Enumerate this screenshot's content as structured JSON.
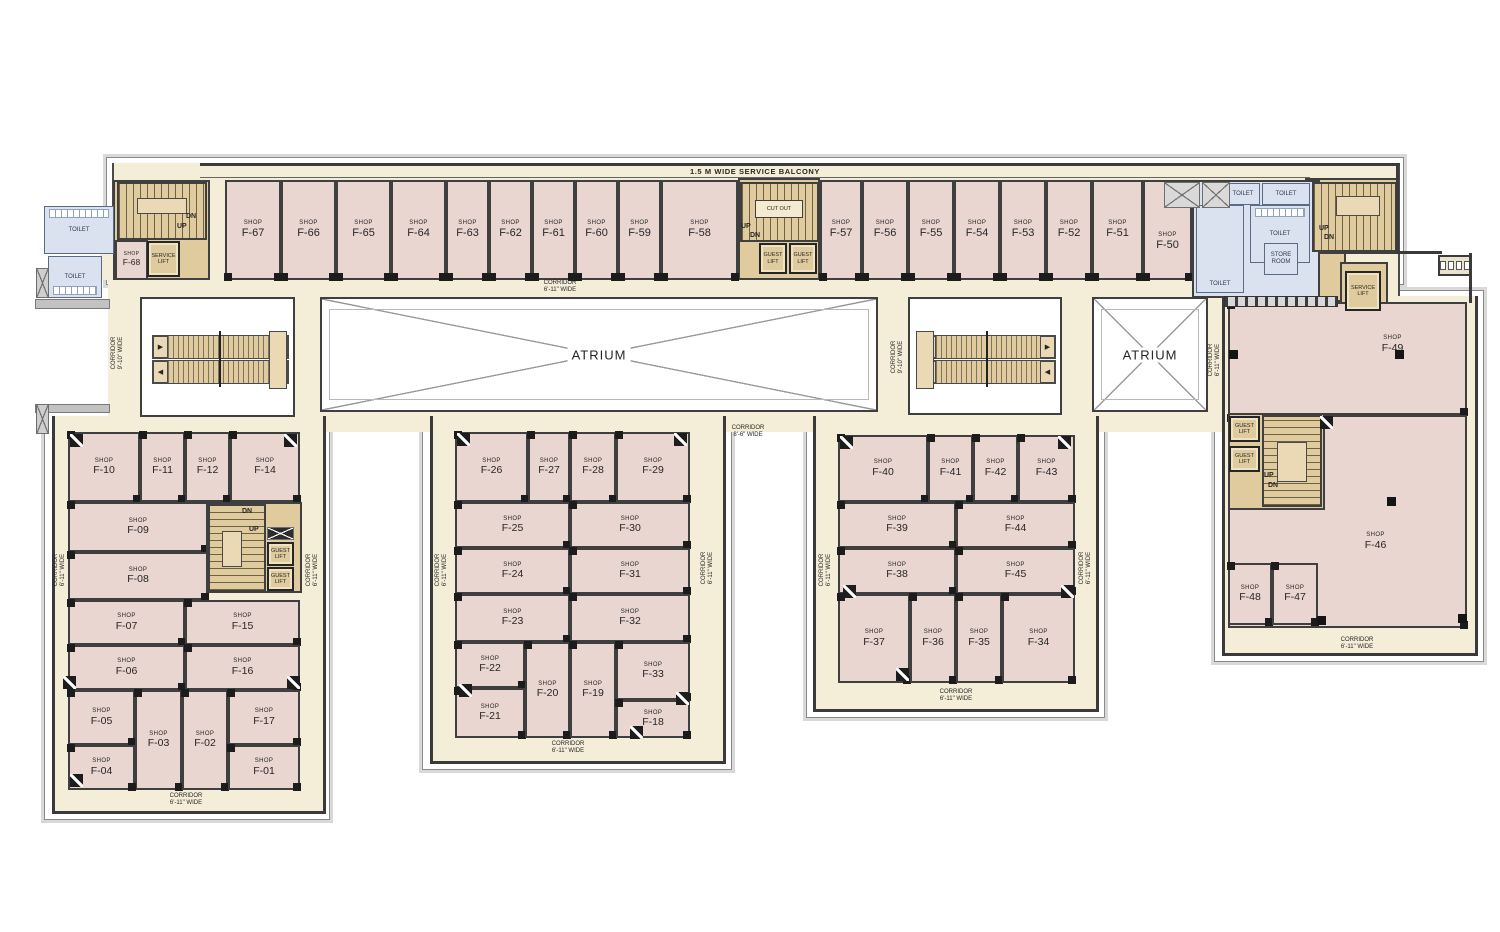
{
  "palette": {
    "cream": "#f4eed8",
    "pink": "#e9d6d1",
    "tan": "#e0cb9e",
    "tanlight": "#ead9b4",
    "blue": "#dbe2ef",
    "wall": "#3a3a3a",
    "text": "#262626"
  },
  "plan": {
    "balcony_label": "1.5 M WIDE SERVICE BALCONY",
    "shop_prefix": "SHOP",
    "atrium_label": "ATRIUM",
    "corridor_word": "CORRIDOR",
    "cutout_label": "CUT OUT",
    "arrow_right": "▶",
    "arrow_left": "◀",
    "balcony": {
      "x": 200,
      "y": 163,
      "w": 1110,
      "h": 15
    },
    "outer_bands": [
      {
        "x": 106,
        "y": 157,
        "w": 1298,
        "h": 128
      },
      {
        "x": 44,
        "y": 410,
        "w": 286,
        "h": 410
      },
      {
        "x": 422,
        "y": 410,
        "w": 310,
        "h": 360
      },
      {
        "x": 806,
        "y": 410,
        "w": 299,
        "h": 308
      },
      {
        "x": 1214,
        "y": 290,
        "w": 270,
        "h": 372
      }
    ],
    "floor_areas": [
      {
        "x": 112,
        "y": 163,
        "w": 1288,
        "h": 144,
        "b": 2
      },
      {
        "x": 108,
        "y": 278,
        "w": 1117,
        "h": 154
      },
      {
        "x": 52,
        "y": 416,
        "w": 274,
        "h": 398,
        "b": 1
      },
      {
        "x": 430,
        "y": 416,
        "w": 296,
        "h": 348,
        "b": 1
      },
      {
        "x": 813,
        "y": 416,
        "w": 286,
        "h": 296,
        "b": 1
      },
      {
        "x": 1222,
        "y": 296,
        "w": 256,
        "h": 360,
        "b": 1
      },
      {
        "x": 100,
        "y": 240,
        "w": 112,
        "h": 40
      }
    ],
    "walls": [
      {
        "x": 1310,
        "y": 163,
        "w": 90,
        "h": 3
      },
      {
        "x": 1396,
        "y": 164,
        "w": 3,
        "h": 90
      },
      {
        "x": 1396,
        "y": 251,
        "w": 46,
        "h": 3
      },
      {
        "x": 1469,
        "y": 253,
        "w": 3,
        "h": 50
      }
    ],
    "grey_walls": [
      {
        "x": 35,
        "y": 299,
        "w": 75,
        "h": 10
      },
      {
        "x": 35,
        "y": 404,
        "w": 75,
        "h": 9
      }
    ],
    "tan_areas": [
      {
        "x": 113,
        "y": 180,
        "w": 97,
        "h": 100,
        "z": 1
      },
      {
        "x": 738,
        "y": 178,
        "w": 82,
        "h": 102,
        "z": 1
      },
      {
        "x": 1305,
        "y": 178,
        "w": 93,
        "h": 76,
        "z": 1
      },
      {
        "x": 1310,
        "y": 252,
        "w": 36,
        "h": 50,
        "z": 1
      },
      {
        "x": 1340,
        "y": 262,
        "w": 48,
        "h": 50,
        "z": 1
      },
      {
        "x": 206,
        "y": 502,
        "w": 96,
        "h": 91,
        "z": 3
      },
      {
        "x": 1228,
        "y": 413,
        "w": 97,
        "h": 97,
        "z": 3
      }
    ],
    "atriums": [
      {
        "x": 320,
        "y": 297,
        "w": 558,
        "h": 115
      },
      {
        "x": 1092,
        "y": 297,
        "w": 116,
        "h": 115
      }
    ],
    "escalators": [
      {
        "x": 140,
        "y": 297,
        "w": 155,
        "h": 120,
        "pad": "right"
      },
      {
        "x": 908,
        "y": 297,
        "w": 154,
        "h": 118,
        "pad": "left"
      }
    ],
    "shops": [
      {
        "id": "F-67",
        "x": 225,
        "y": 180,
        "w": 56,
        "h": 100,
        "cls": "top"
      },
      {
        "id": "F-66",
        "x": 281,
        "y": 180,
        "w": 55,
        "h": 100,
        "cls": "top"
      },
      {
        "id": "F-65",
        "x": 336,
        "y": 180,
        "w": 55,
        "h": 100,
        "cls": "top"
      },
      {
        "id": "F-64",
        "x": 391,
        "y": 180,
        "w": 55,
        "h": 100,
        "cls": "top"
      },
      {
        "id": "F-63",
        "x": 446,
        "y": 180,
        "w": 43,
        "h": 100,
        "cls": "top"
      },
      {
        "id": "F-62",
        "x": 489,
        "y": 180,
        "w": 43,
        "h": 100,
        "cls": "top"
      },
      {
        "id": "F-61",
        "x": 532,
        "y": 180,
        "w": 43,
        "h": 100,
        "cls": "top"
      },
      {
        "id": "F-60",
        "x": 575,
        "y": 180,
        "w": 43,
        "h": 100,
        "cls": "top"
      },
      {
        "id": "F-59",
        "x": 618,
        "y": 180,
        "w": 43,
        "h": 100,
        "cls": "top"
      },
      {
        "id": "F-58",
        "x": 661,
        "y": 180,
        "w": 77,
        "h": 100,
        "cls": "top"
      },
      {
        "id": "F-57",
        "x": 820,
        "y": 180,
        "w": 42,
        "h": 100,
        "cls": "top"
      },
      {
        "id": "F-56",
        "x": 862,
        "y": 180,
        "w": 46,
        "h": 100,
        "cls": "top"
      },
      {
        "id": "F-55",
        "x": 908,
        "y": 180,
        "w": 46,
        "h": 100,
        "cls": "top"
      },
      {
        "id": "F-54",
        "x": 954,
        "y": 180,
        "w": 46,
        "h": 100,
        "cls": "top"
      },
      {
        "id": "F-53",
        "x": 1000,
        "y": 180,
        "w": 46,
        "h": 100,
        "cls": "top"
      },
      {
        "id": "F-52",
        "x": 1046,
        "y": 180,
        "w": 46,
        "h": 100,
        "cls": "top"
      },
      {
        "id": "F-51",
        "x": 1092,
        "y": 180,
        "w": 51,
        "h": 100,
        "cls": "top"
      },
      {
        "id": "F-50",
        "x": 1143,
        "y": 180,
        "w": 49,
        "h": 100,
        "cls": "top",
        "dy": 12
      },
      {
        "id": "F-68",
        "x": 115,
        "y": 240,
        "w": 33,
        "h": 40,
        "cls": "small"
      },
      {
        "id": "F-49",
        "x": 1228,
        "y": 302,
        "w": 239,
        "h": 113,
        "cls": "blk",
        "dx": 45,
        "dy": -14
      },
      {
        "id": "F-46",
        "x": 1228,
        "y": 415,
        "w": 239,
        "h": 213,
        "cls": "blk",
        "dx": 28,
        "dy": 20
      },
      {
        "id": "F-48",
        "x": 1228,
        "y": 563,
        "w": 44,
        "h": 62,
        "cls": "blk"
      },
      {
        "id": "F-47",
        "x": 1272,
        "y": 563,
        "w": 46,
        "h": 62,
        "cls": "blk"
      },
      {
        "id": "F-10",
        "x": 68,
        "y": 432,
        "w": 72,
        "h": 70,
        "cls": "blk"
      },
      {
        "id": "F-11",
        "x": 140,
        "y": 432,
        "w": 45,
        "h": 70,
        "cls": "blk"
      },
      {
        "id": "F-12",
        "x": 185,
        "y": 432,
        "w": 45,
        "h": 70,
        "cls": "blk"
      },
      {
        "id": "F-14",
        "x": 230,
        "y": 432,
        "w": 70,
        "h": 70,
        "cls": "blk"
      },
      {
        "id": "F-09",
        "x": 68,
        "y": 502,
        "w": 140,
        "h": 50,
        "cls": "blk"
      },
      {
        "id": "F-08",
        "x": 68,
        "y": 552,
        "w": 140,
        "h": 48,
        "cls": "blk"
      },
      {
        "id": "F-07",
        "x": 68,
        "y": 600,
        "w": 117,
        "h": 45,
        "cls": "blk"
      },
      {
        "id": "F-15",
        "x": 185,
        "y": 600,
        "w": 115,
        "h": 45,
        "cls": "blk"
      },
      {
        "id": "F-06",
        "x": 68,
        "y": 645,
        "w": 117,
        "h": 45,
        "cls": "blk"
      },
      {
        "id": "F-16",
        "x": 185,
        "y": 645,
        "w": 115,
        "h": 45,
        "cls": "blk"
      },
      {
        "id": "F-05",
        "x": 68,
        "y": 690,
        "w": 67,
        "h": 55,
        "cls": "blk"
      },
      {
        "id": "F-03",
        "x": 135,
        "y": 690,
        "w": 47,
        "h": 100,
        "cls": "blk"
      },
      {
        "id": "F-02",
        "x": 182,
        "y": 690,
        "w": 46,
        "h": 100,
        "cls": "blk"
      },
      {
        "id": "F-17",
        "x": 228,
        "y": 690,
        "w": 72,
        "h": 55,
        "cls": "blk"
      },
      {
        "id": "F-04",
        "x": 68,
        "y": 745,
        "w": 67,
        "h": 45,
        "cls": "blk"
      },
      {
        "id": "F-01",
        "x": 228,
        "y": 745,
        "w": 72,
        "h": 45,
        "cls": "blk"
      },
      {
        "id": "F-26",
        "x": 455,
        "y": 432,
        "w": 73,
        "h": 70,
        "cls": "blk"
      },
      {
        "id": "F-27",
        "x": 528,
        "y": 432,
        "w": 42,
        "h": 70,
        "cls": "blk"
      },
      {
        "id": "F-28",
        "x": 570,
        "y": 432,
        "w": 46,
        "h": 70,
        "cls": "blk"
      },
      {
        "id": "F-29",
        "x": 616,
        "y": 432,
        "w": 74,
        "h": 70,
        "cls": "blk"
      },
      {
        "id": "F-25",
        "x": 455,
        "y": 502,
        "w": 115,
        "h": 46,
        "cls": "blk"
      },
      {
        "id": "F-30",
        "x": 570,
        "y": 502,
        "w": 120,
        "h": 46,
        "cls": "blk"
      },
      {
        "id": "F-24",
        "x": 455,
        "y": 548,
        "w": 115,
        "h": 46,
        "cls": "blk"
      },
      {
        "id": "F-31",
        "x": 570,
        "y": 548,
        "w": 120,
        "h": 46,
        "cls": "blk"
      },
      {
        "id": "F-23",
        "x": 455,
        "y": 594,
        "w": 115,
        "h": 48,
        "cls": "blk"
      },
      {
        "id": "F-32",
        "x": 570,
        "y": 594,
        "w": 120,
        "h": 48,
        "cls": "blk"
      },
      {
        "id": "F-22",
        "x": 455,
        "y": 642,
        "w": 70,
        "h": 46,
        "cls": "blk"
      },
      {
        "id": "F-21",
        "x": 455,
        "y": 688,
        "w": 70,
        "h": 50,
        "cls": "blk"
      },
      {
        "id": "F-20",
        "x": 525,
        "y": 642,
        "w": 45,
        "h": 96,
        "cls": "blk"
      },
      {
        "id": "F-19",
        "x": 570,
        "y": 642,
        "w": 46,
        "h": 96,
        "cls": "blk"
      },
      {
        "id": "F-33",
        "x": 616,
        "y": 642,
        "w": 74,
        "h": 58,
        "cls": "blk"
      },
      {
        "id": "F-18",
        "x": 616,
        "y": 700,
        "w": 74,
        "h": 38,
        "cls": "blk"
      },
      {
        "id": "F-40",
        "x": 838,
        "y": 435,
        "w": 90,
        "h": 67,
        "cls": "blk"
      },
      {
        "id": "F-41",
        "x": 928,
        "y": 435,
        "w": 45,
        "h": 67,
        "cls": "blk"
      },
      {
        "id": "F-42",
        "x": 973,
        "y": 435,
        "w": 45,
        "h": 67,
        "cls": "blk"
      },
      {
        "id": "F-43",
        "x": 1018,
        "y": 435,
        "w": 57,
        "h": 67,
        "cls": "blk"
      },
      {
        "id": "F-39",
        "x": 838,
        "y": 502,
        "w": 118,
        "h": 46,
        "cls": "blk"
      },
      {
        "id": "F-44",
        "x": 956,
        "y": 502,
        "w": 119,
        "h": 46,
        "cls": "blk"
      },
      {
        "id": "F-38",
        "x": 838,
        "y": 548,
        "w": 118,
        "h": 46,
        "cls": "blk"
      },
      {
        "id": "F-45",
        "x": 956,
        "y": 548,
        "w": 119,
        "h": 46,
        "cls": "blk"
      },
      {
        "id": "F-37",
        "x": 838,
        "y": 594,
        "w": 72,
        "h": 89,
        "cls": "blk"
      },
      {
        "id": "F-36",
        "x": 910,
        "y": 594,
        "w": 46,
        "h": 89,
        "cls": "blk"
      },
      {
        "id": "F-35",
        "x": 956,
        "y": 594,
        "w": 46,
        "h": 89,
        "cls": "blk"
      },
      {
        "id": "F-34",
        "x": 1002,
        "y": 594,
        "w": 73,
        "h": 89,
        "cls": "blk"
      }
    ],
    "stairs": [
      {
        "x": 117,
        "y": 182,
        "w": 90,
        "h": 58,
        "dir": "h"
      },
      {
        "x": 740,
        "y": 182,
        "w": 79,
        "h": 60,
        "dir": "h"
      },
      {
        "x": 1312,
        "y": 182,
        "w": 85,
        "h": 70,
        "dir": "h"
      },
      {
        "x": 208,
        "y": 504,
        "w": 58,
        "h": 88,
        "dir": "v"
      },
      {
        "x": 1262,
        "y": 415,
        "w": 60,
        "h": 92,
        "dir": "v"
      }
    ],
    "landings": [
      {
        "x": 137,
        "y": 198,
        "w": 50,
        "h": 16
      },
      {
        "x": 1336,
        "y": 196,
        "w": 44,
        "h": 20
      },
      {
        "x": 222,
        "y": 531,
        "w": 20,
        "h": 36
      },
      {
        "x": 1277,
        "y": 442,
        "w": 30,
        "h": 40
      }
    ],
    "cutout": {
      "x": 755,
      "y": 200,
      "w": 48,
      "h": 18
    },
    "stair_labels": [
      {
        "t": "DN",
        "x": 186,
        "y": 213
      },
      {
        "t": "UP",
        "x": 177,
        "y": 223
      },
      {
        "t": "UP",
        "x": 741,
        "y": 223
      },
      {
        "t": "DN",
        "x": 750,
        "y": 232
      },
      {
        "t": "UP",
        "x": 1319,
        "y": 225
      },
      {
        "t": "DN",
        "x": 1324,
        "y": 234
      },
      {
        "t": "DN",
        "x": 242,
        "y": 508
      },
      {
        "t": "UP",
        "x": 249,
        "y": 526
      },
      {
        "t": "UP",
        "x": 1264,
        "y": 472
      },
      {
        "t": "DN",
        "x": 1268,
        "y": 482
      }
    ],
    "lifts": [
      {
        "x": 147,
        "y": 241,
        "w": 33,
        "h": 36,
        "label": "SERVICE\nLIFT"
      },
      {
        "x": 759,
        "y": 243,
        "w": 28,
        "h": 31,
        "label": "GUEST\nLIFT"
      },
      {
        "x": 789,
        "y": 243,
        "w": 28,
        "h": 31,
        "label": "GUEST\nLIFT"
      },
      {
        "x": 1345,
        "y": 271,
        "w": 36,
        "h": 40,
        "label": "SERVICE\nLIFT"
      },
      {
        "x": 267,
        "y": 542,
        "w": 27,
        "h": 24,
        "label": "GUEST\nLIFT"
      },
      {
        "x": 267,
        "y": 567,
        "w": 27,
        "h": 24,
        "label": "GUEST\nLIFT"
      },
      {
        "x": 1229,
        "y": 416,
        "w": 31,
        "h": 26,
        "label": "GUEST\nLIFT"
      },
      {
        "x": 1229,
        "y": 446,
        "w": 31,
        "h": 26,
        "label": "GUEST\nLIFT"
      }
    ],
    "toilet_base": {
      "x": 1192,
      "y": 180,
      "w": 128,
      "h": 118
    },
    "toilet_rooms": [
      {
        "x": 44,
        "y": 206,
        "w": 70,
        "h": 48,
        "label": "TOILET",
        "fx": "top"
      },
      {
        "x": 48,
        "y": 256,
        "w": 54,
        "h": 42,
        "label": "TOILET",
        "fx": "bottom"
      },
      {
        "x": 1226,
        "y": 183,
        "w": 34,
        "h": 22,
        "label": "TOILET"
      },
      {
        "x": 1262,
        "y": 183,
        "w": 48,
        "h": 22,
        "label": "TOILET"
      },
      {
        "x": 1250,
        "y": 205,
        "w": 60,
        "h": 58,
        "label": "TOILET",
        "fx": "top"
      },
      {
        "x": 1196,
        "y": 205,
        "w": 48,
        "h": 88,
        "label": "TOILET",
        "pos": "bottom"
      },
      {
        "x": 1264,
        "y": 243,
        "w": 34,
        "h": 32,
        "label": "STORE\nROOM"
      }
    ],
    "counter": {
      "x": 1224,
      "y": 296,
      "w": 114,
      "h": 11
    },
    "xboxes": [
      {
        "x": 1164,
        "y": 182,
        "w": 36,
        "h": 26
      },
      {
        "x": 1202,
        "y": 182,
        "w": 28,
        "h": 26
      },
      {
        "x": 36,
        "y": 268,
        "w": 13,
        "h": 30,
        "cls": "hatch"
      },
      {
        "x": 36,
        "y": 404,
        "w": 13,
        "h": 30,
        "cls": "hatch"
      },
      {
        "x": 267,
        "y": 527,
        "w": 27,
        "h": 13,
        "cls": "dark"
      }
    ],
    "corner_markers": [
      [
        70,
        434
      ],
      [
        284,
        434
      ],
      [
        63,
        676
      ],
      [
        287,
        676
      ],
      [
        70,
        774
      ],
      [
        457,
        433
      ],
      [
        674,
        433
      ],
      [
        459,
        684
      ],
      [
        676,
        692
      ],
      [
        630,
        726
      ],
      [
        840,
        436
      ],
      [
        1058,
        436
      ],
      [
        843,
        585
      ],
      [
        1061,
        585
      ],
      [
        896,
        668
      ],
      [
        1320,
        416
      ]
    ],
    "columns": [
      [
        1395,
        350
      ],
      [
        1387,
        497
      ],
      [
        1317,
        616
      ],
      [
        1458,
        614
      ],
      [
        1229,
        350
      ]
    ],
    "corridors": [
      {
        "x": 560,
        "y": 287,
        "rot": 0,
        "w2": "6'-11\" WIDE"
      },
      {
        "x": 748,
        "y": 432,
        "rot": 0,
        "w2": "8'-6\" WIDE"
      },
      {
        "x": 118,
        "y": 353,
        "rot": 90,
        "w2": "9'-10\" WIDE"
      },
      {
        "x": 898,
        "y": 357,
        "rot": 90,
        "w2": "9'-10\" WIDE"
      },
      {
        "x": 1215,
        "y": 360,
        "rot": 90,
        "w2": "6'-11\" WIDE"
      },
      {
        "x": 60,
        "y": 570,
        "rot": 90,
        "w2": "6'-11\" WIDE"
      },
      {
        "x": 313,
        "y": 570,
        "rot": 90,
        "w2": "6'-11\" WIDE"
      },
      {
        "x": 186,
        "y": 800,
        "rot": 0,
        "w2": "6'-11\" WIDE"
      },
      {
        "x": 442,
        "y": 570,
        "rot": 90,
        "w2": "6'-11\" WIDE"
      },
      {
        "x": 708,
        "y": 568,
        "rot": 90,
        "w2": "6'-11\" WIDE"
      },
      {
        "x": 568,
        "y": 748,
        "rot": 0,
        "w2": "6'-11\" WIDE"
      },
      {
        "x": 826,
        "y": 570,
        "rot": 90,
        "w2": "6'-11\" WIDE"
      },
      {
        "x": 1086,
        "y": 568,
        "rot": 90,
        "w2": "6'-11\" WIDE"
      },
      {
        "x": 956,
        "y": 696,
        "rot": 0,
        "w2": "6'-11\" WIDE"
      },
      {
        "x": 1357,
        "y": 644,
        "rot": 0,
        "w2": "6'-11\" WIDE"
      }
    ],
    "fixture_box": {
      "x": 1438,
      "y": 255,
      "w": 34,
      "h": 21
    }
  }
}
